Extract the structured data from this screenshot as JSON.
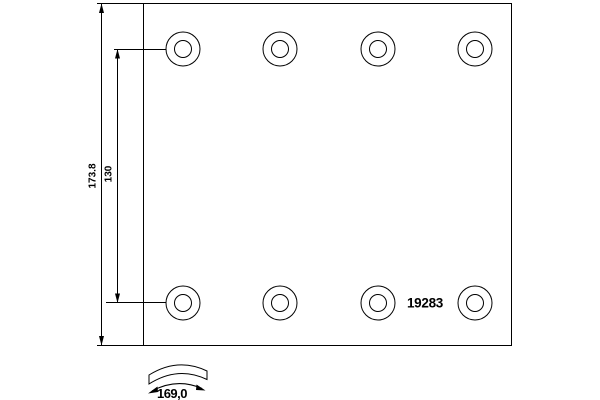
{
  "page": {
    "background_color": "#ffffff",
    "line_color": "#000000"
  },
  "drawing": {
    "kind": "brake-lining-technical-drawing",
    "part_number": "19283",
    "dimensions": {
      "overall_height_label": "173.8",
      "rivet_row_spacing_label": "130",
      "curvature_radius_label": "169,0"
    },
    "plate": {
      "rivet_hole_rows": 2,
      "rivet_holes_per_row": 4,
      "total_rivet_holes": 8
    }
  }
}
